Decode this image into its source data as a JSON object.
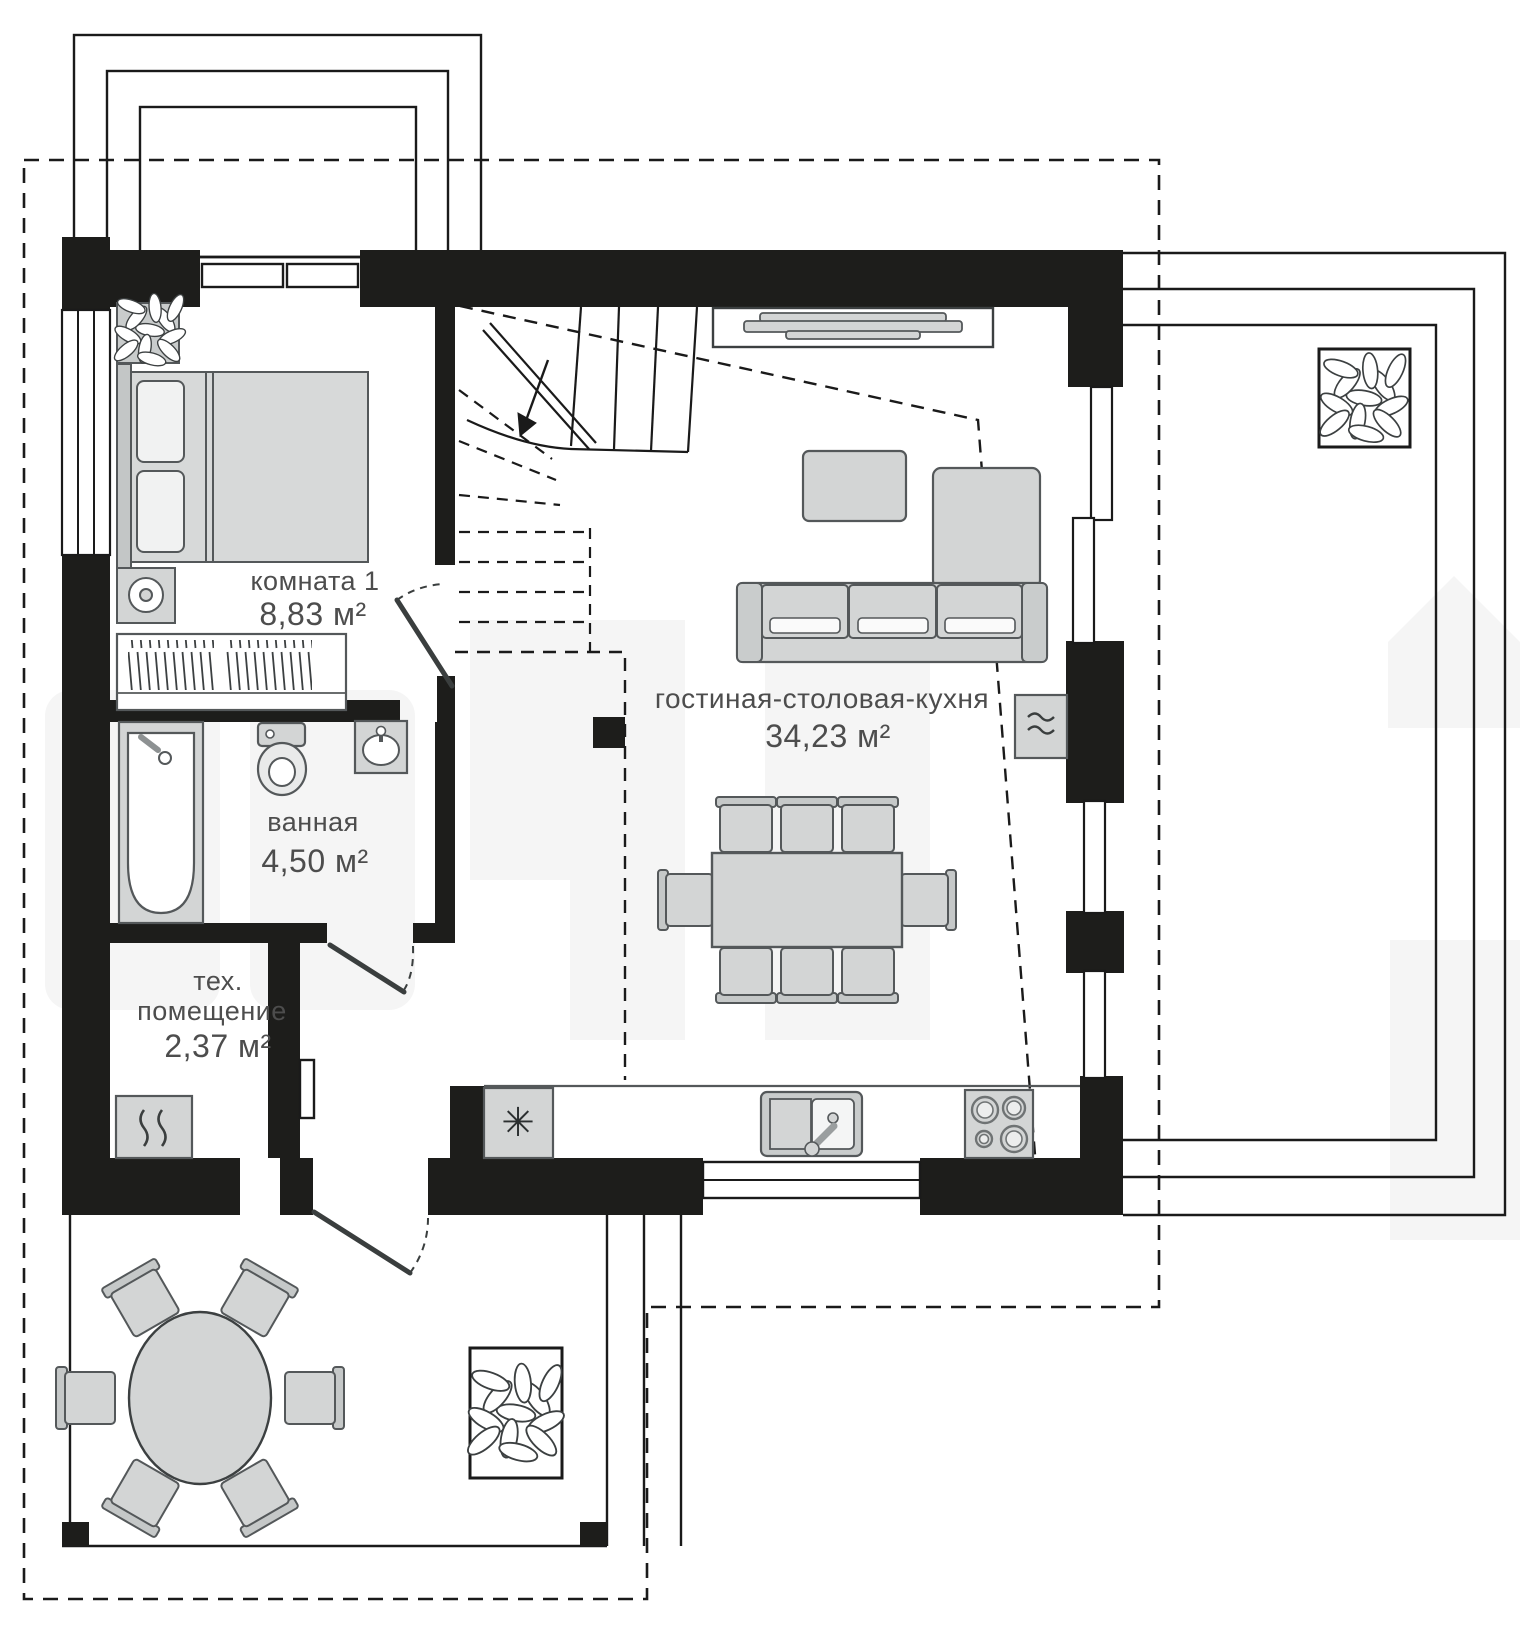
{
  "plan": {
    "type": "floor-plan",
    "language": "ru",
    "rooms": {
      "bedroom": {
        "name": "комната 1",
        "area": "8,83 м²"
      },
      "bathroom": {
        "name": "ванная",
        "area": "4,50 м²"
      },
      "tech": {
        "name_line_1": "тех.",
        "name_line_2": "помещение",
        "area": "2,37 м²"
      },
      "living": {
        "name": "гостиная-столовая-кухня",
        "area": "34,23 м²"
      }
    },
    "icons": {
      "fridge": "✳",
      "heater": "≈",
      "boiler": "wavy-flue-lines",
      "stairs_direction": "arrow-down-left"
    },
    "colors": {
      "wall": "#1d1d1b",
      "furniture_fill": "#d3d5d5",
      "furniture_fill_light": "#e9eaea",
      "furniture_stroke": "#54585a",
      "architecture_line": "#1a1a1a",
      "label_text": "#4d4d4d",
      "background": "#ffffff",
      "watermark": "#f5f5f5"
    }
  }
}
